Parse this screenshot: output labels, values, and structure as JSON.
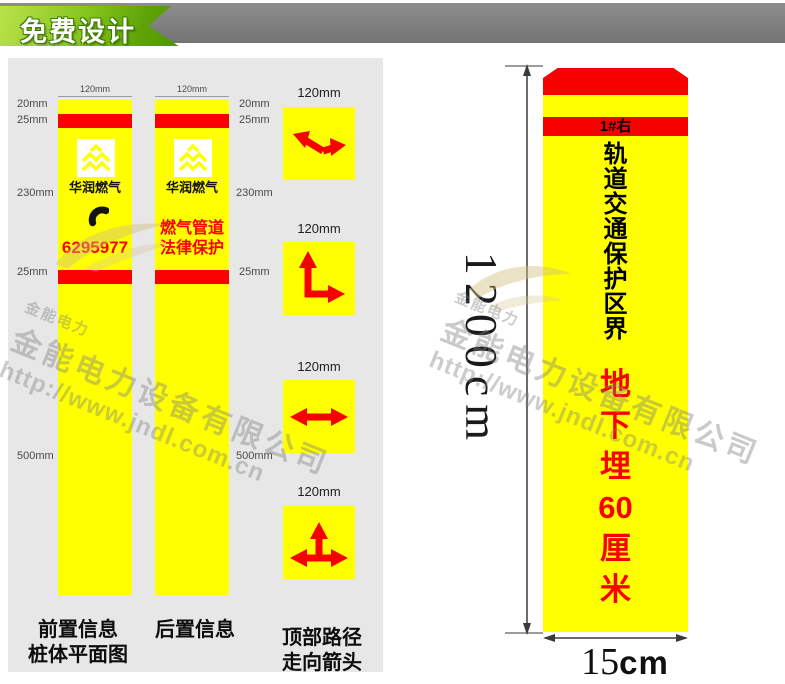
{
  "banner": {
    "label": "免费设计"
  },
  "colors": {
    "post_yellow": "#ffff00",
    "stripe_red": "#fb0000",
    "ribbon_green": "#74b608",
    "bar_gray": "#7d7d7d",
    "panel_gray": "#e7e7e7"
  },
  "diagram": {
    "front_post": {
      "width_label": "120mm",
      "brand": "华润燃气",
      "phone_number": "6295977",
      "caption": [
        "前置信息",
        "桩体平面图"
      ]
    },
    "back_post": {
      "width_label": "120mm",
      "brand": "华润燃气",
      "warning": [
        "燃气管道",
        "法律保护"
      ],
      "caption": [
        "后置信息"
      ]
    },
    "left_measurements": [
      "20mm",
      "25mm",
      "230mm",
      "25mm",
      "500mm"
    ],
    "right_measurements": [
      "20mm",
      "25mm",
      "230mm",
      "25mm",
      "500mm"
    ],
    "arrow_tiles": [
      {
        "width_label": "120mm",
        "arrow": "turn-back-left"
      },
      {
        "width_label": "120mm",
        "arrow": "corner-up-right"
      },
      {
        "width_label": "120mm",
        "arrow": "straight-both-ways"
      },
      {
        "width_label": "120mm",
        "arrow": "tee-junction"
      }
    ],
    "tiles_caption": [
      "顶部路径",
      "走向箭头"
    ]
  },
  "pile_preview": {
    "tag": "1#右",
    "title": "轨道交通保护区界",
    "title_chars": [
      "轨",
      "道",
      "交",
      "通",
      "保",
      "护",
      "区",
      "界"
    ],
    "subtitle": "地下埋60厘米",
    "subtitle_chars": [
      "地",
      "下",
      "埋",
      "60",
      "厘",
      "米"
    ],
    "height_label": "1200cm",
    "width_value": "15",
    "width_unit": "cm"
  },
  "watermark": {
    "brand": "金能电力",
    "company": "金能电力设备有限公司",
    "url": "http://www.jndl.com.cn"
  }
}
